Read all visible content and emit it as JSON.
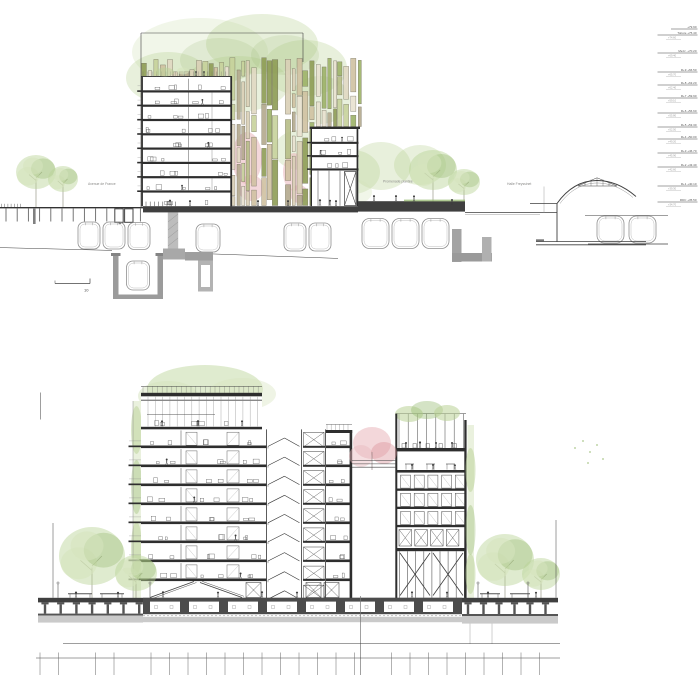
{
  "labels": {
    "avenue_de_france": "Avenue de France",
    "promenade_plantee": "Promenade plantée",
    "halle_freyssinet": "Halle Freyssinet",
    "scale_value": "10"
  },
  "levels": {
    "items": [
      {
        "y": 29,
        "label": "",
        "elev": "+79.90",
        "sub": ""
      },
      {
        "y": 35,
        "label": "Toiture",
        "elev": "+75.40",
        "sub": "+74.60"
      },
      {
        "y": 53,
        "label": "Mezz.",
        "elev": "+70.20",
        "sub": "+69.40"
      },
      {
        "y": 72,
        "label": "R+9",
        "elev": "+66.50",
        "sub": "+65.70"
      },
      {
        "y": 85,
        "label": "R+8",
        "elev": "+63.20",
        "sub": "+62.40"
      },
      {
        "y": 98,
        "label": "R+7",
        "elev": "+59.90",
        "sub": "+59.10"
      },
      {
        "y": 113,
        "label": "R+6",
        "elev": "+56.60",
        "sub": "+55.80"
      },
      {
        "y": 127,
        "label": "R+5",
        "elev": "+53.30",
        "sub": "+52.50"
      },
      {
        "y": 139,
        "label": "R+4",
        "elev": "+50.00",
        "sub": "+49.20"
      },
      {
        "y": 153,
        "label": "R+3",
        "elev": "+46.70",
        "sub": "+45.90"
      },
      {
        "y": 167,
        "label": "R+2",
        "elev": "+43.40",
        "sub": "+42.60"
      },
      {
        "y": 186,
        "label": "R+1",
        "elev": "+40.10",
        "sub": "+39.30"
      },
      {
        "y": 202,
        "label": "RDC",
        "elev": "+35.50",
        "sub": "+34.70"
      }
    ]
  },
  "colors": {
    "line": "#3f3f3f",
    "slab": "#2e2e2e",
    "slab_band": "#3f3f3f",
    "gray_fill": "#cacaca",
    "tree_green_light": "#d6e4bd",
    "tree_green": "#b9d295",
    "tree_green_dark": "#94b86e",
    "blossom_pink": "#e9b7bc",
    "blossom_pink_dark": "#d98f97",
    "facade_palette": [
      "#d9cfb6",
      "#cfc1a1",
      "#b6bd86",
      "#9cb167",
      "#c7d29b",
      "#e8e1cf",
      "#b2a88d",
      "#8e9c55",
      "#e0d8c2"
    ]
  }
}
